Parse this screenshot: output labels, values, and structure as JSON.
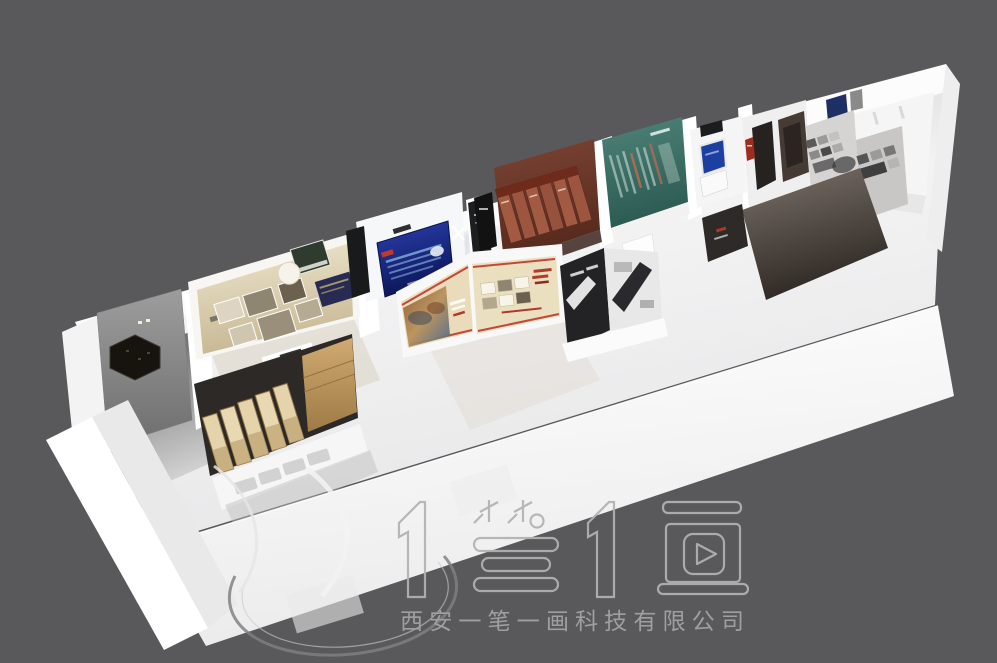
{
  "watermark": {
    "logo_text": "1笔1画",
    "company_name": "西安一笔一画科技有限公司"
  },
  "colors": {
    "background": "#59595b",
    "hall_white": "#f8f8f9",
    "front_wall": "#ffffff",
    "floor": "#ececec",
    "entrance_wall_gray": "#8d8d8d",
    "emblem_black": "#17140f",
    "history_wall_beige": "#e3d7ba",
    "cabinet_dark": "#2c2926",
    "cabinet_wood": "#c29b63",
    "screen_blue": "#1c2f97",
    "maroon_wall": "#6e382a",
    "panel_red": "#a25a42",
    "teal_wall": "#3f7065",
    "tv_blue": "#1d3fa0",
    "gallery_beige": "#eadcba",
    "trim_red": "#c2483a",
    "mono_dark": "#232326",
    "mono_light": "#e8e8e8",
    "dark_room_floor": "#3a332e",
    "watermark_gray": "#b2b2b2",
    "company_text_gray": "#a5a5a5"
  }
}
